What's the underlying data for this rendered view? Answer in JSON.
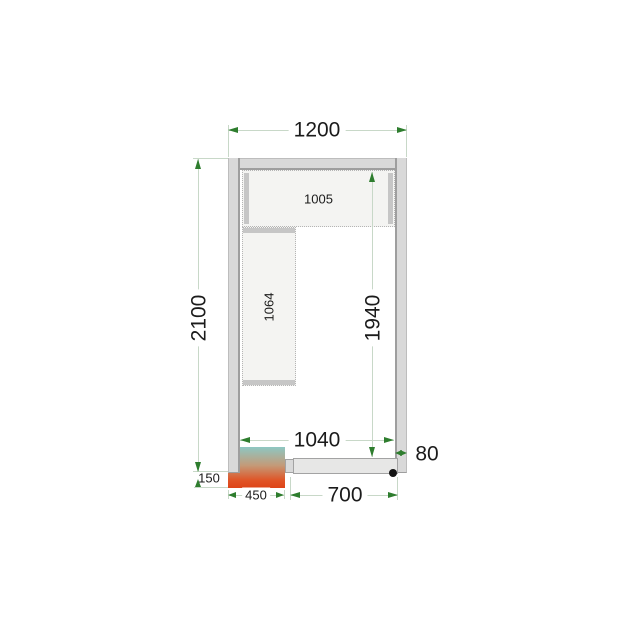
{
  "diagram": {
    "labels": {
      "outer_width": "1200",
      "outer_depth": "2100",
      "inner_width": "1040",
      "inner_depth": "1940",
      "top_shelf": "1005",
      "side_shelf": "1064",
      "door_width": "700",
      "unit_width": "450",
      "unit_overhang": "150",
      "wall_thickness": "80"
    },
    "colors": {
      "dimension_line": "#c8d8c8",
      "dimension_arrow": "#2e7d2e",
      "wall_fill": "#d9d9d9",
      "wall_edge": "#9e9e9e",
      "shelf_fill": "#f4f4f2",
      "shelf_rail": "#c6c6c6",
      "door_fill": "#e7e7e6",
      "unit_gradient_top": "#8ec7c2",
      "unit_gradient_mid": "#c49a78",
      "unit_gradient_bottom": "#de4418",
      "door_dot": "#141414",
      "text": "#1b1b1b"
    }
  }
}
